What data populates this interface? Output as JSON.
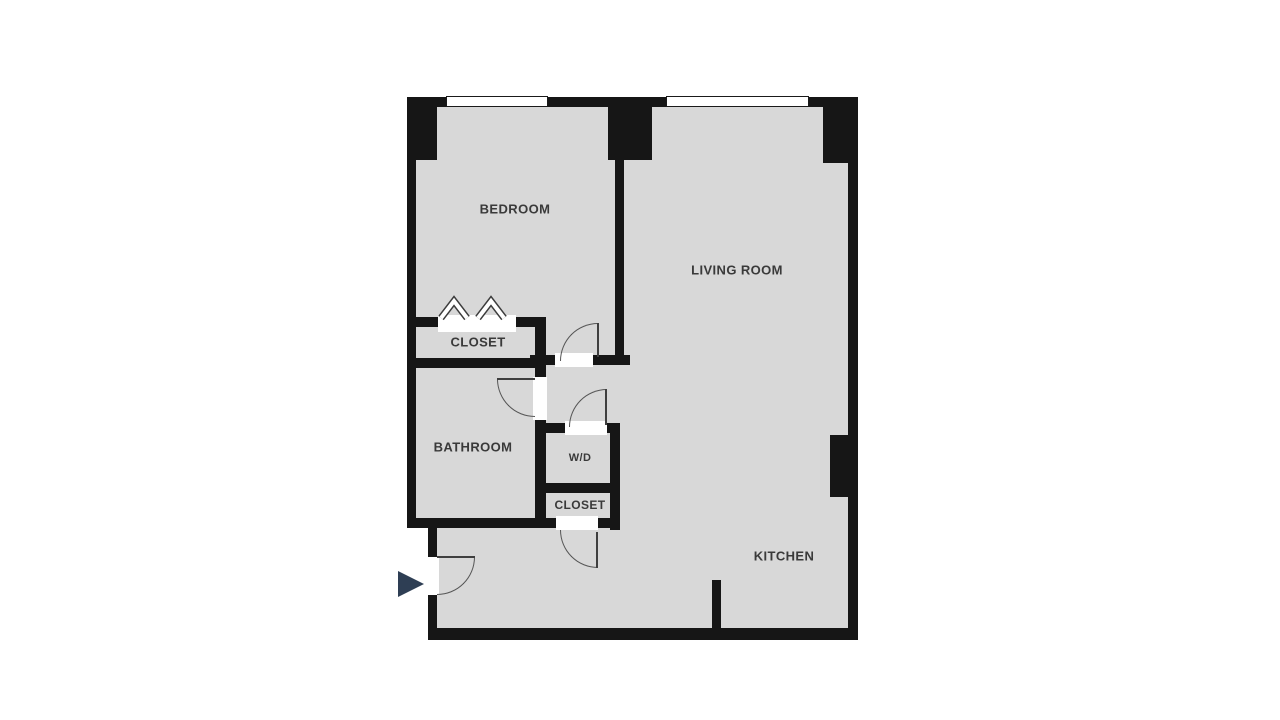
{
  "plan": {
    "title": "one-bedroom apartment floor plan",
    "rooms": [
      {
        "id": "bedroom",
        "label": "BEDROOM"
      },
      {
        "id": "living-room",
        "label": "LIVING ROOM"
      },
      {
        "id": "closet-bedroom",
        "label": "CLOSET"
      },
      {
        "id": "bathroom",
        "label": "BATHROOM"
      },
      {
        "id": "washer-dryer",
        "label": "W/D"
      },
      {
        "id": "closet-hall",
        "label": "CLOSET"
      },
      {
        "id": "kitchen",
        "label": "KITCHEN"
      }
    ],
    "features": {
      "windows": 2,
      "door_arcs": 5,
      "closet_hanger_symbols": 2,
      "entry_marker": "right-pointing triangle at entry door"
    },
    "colors": {
      "wall": "#161616",
      "floor": "#d8d8d8",
      "background": "#ffffff",
      "door_arc": "#555555",
      "label_text": "#3a3a3a",
      "entry_arrow": "#2e3e54"
    }
  }
}
